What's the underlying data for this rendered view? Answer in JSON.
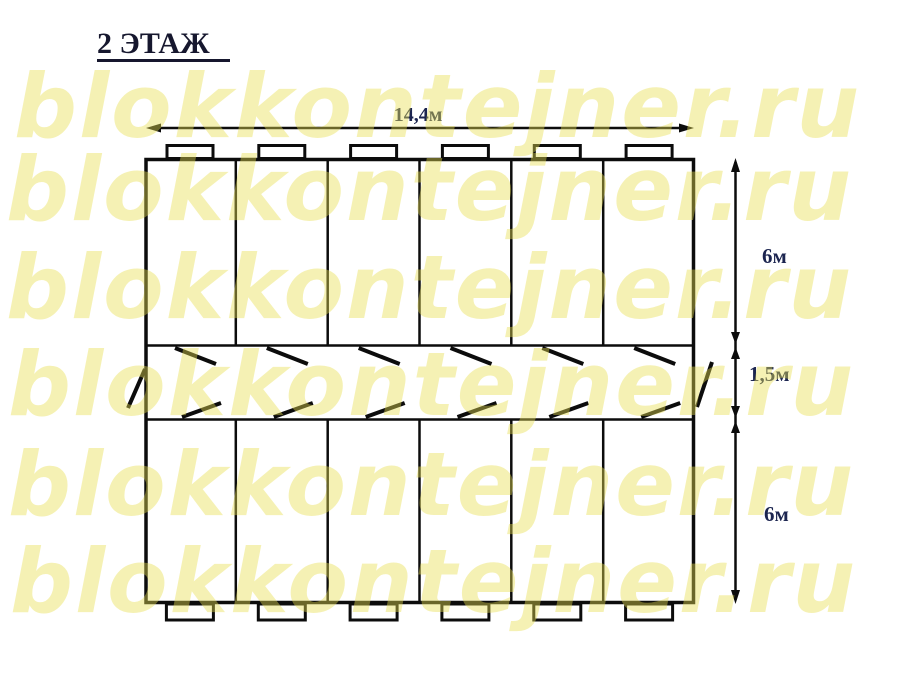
{
  "title": "2 ЭТАЖ",
  "watermark": {
    "text": "blokkontejner.ru",
    "color": "#e7de50"
  },
  "dimensions": {
    "width_label": "14,4м",
    "top_section_label": "6м",
    "corridor_label": "1,5м",
    "bottom_section_label": "6м"
  },
  "colors": {
    "line": "#0c0c0c",
    "dimension_label": "#1c2550",
    "title": "#16172e",
    "watermark": "#f6f2ba"
  }
}
